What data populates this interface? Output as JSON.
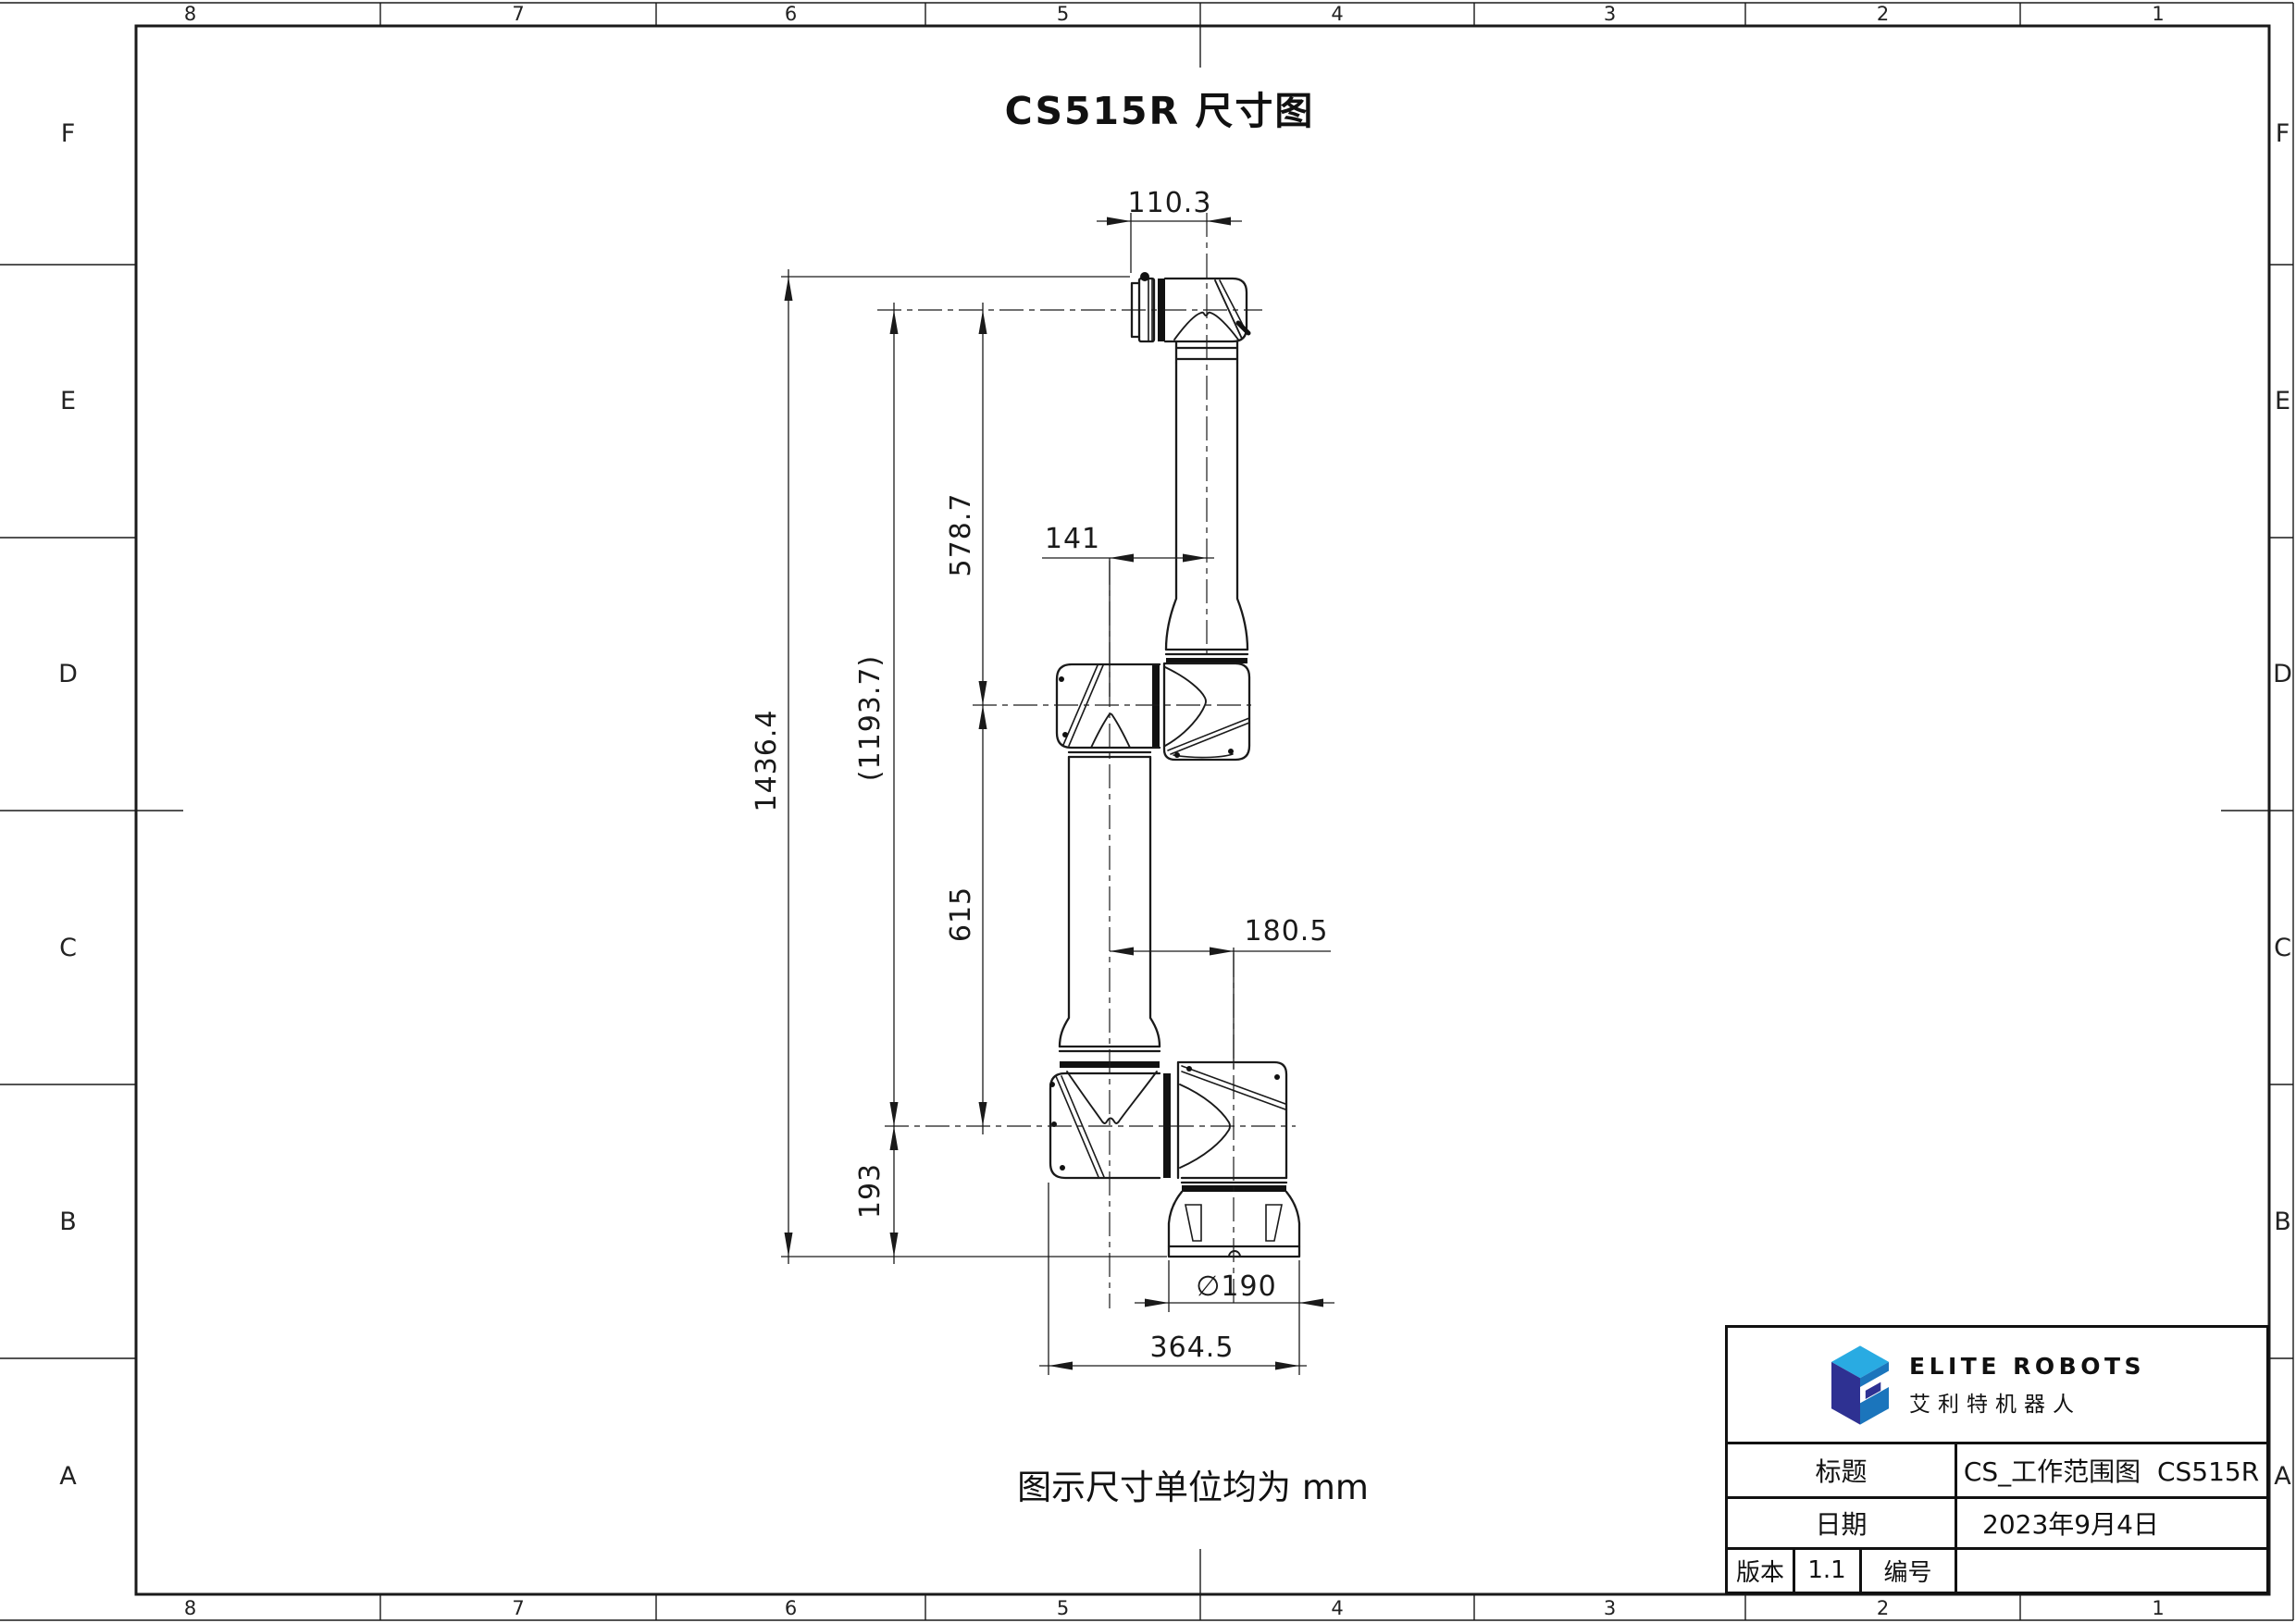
{
  "sheet": {
    "title": "CS515R 尺寸图",
    "unit_note": "图示尺寸单位均为 mm"
  },
  "zones": {
    "cols": [
      "8",
      "7",
      "6",
      "5",
      "4",
      "3",
      "2",
      "1"
    ],
    "rows": [
      "F",
      "E",
      "D",
      "C",
      "B",
      "A"
    ]
  },
  "dims": {
    "flange_width": "110.3",
    "elbow_offset": "141",
    "wrist_to_elbow": "578.7",
    "elbow_to_shoulder": "615",
    "wrist_to_shoulder": "(1193.7)",
    "overall_height": "1436.4",
    "shoulder_to_base": "193",
    "base_axis_offset": "180.5",
    "base_diameter": "∅190",
    "footprint_width": "364.5"
  },
  "title_block": {
    "brand_en": "ELITE ROBOTS",
    "brand_cn": "艾利特机器人",
    "title_label": "标题",
    "title_value": "CS_工作范围图  CS515R",
    "date_label": "日期",
    "date_value": "2023年9月4日",
    "version_label": "版本",
    "version_value": "1.1",
    "number_label": "编号",
    "number_value": ""
  },
  "colors": {
    "line": "#1a1a1a",
    "logo_navy": "#2e3192",
    "logo_cyan": "#29abe2",
    "logo_blue": "#1b75bc"
  }
}
